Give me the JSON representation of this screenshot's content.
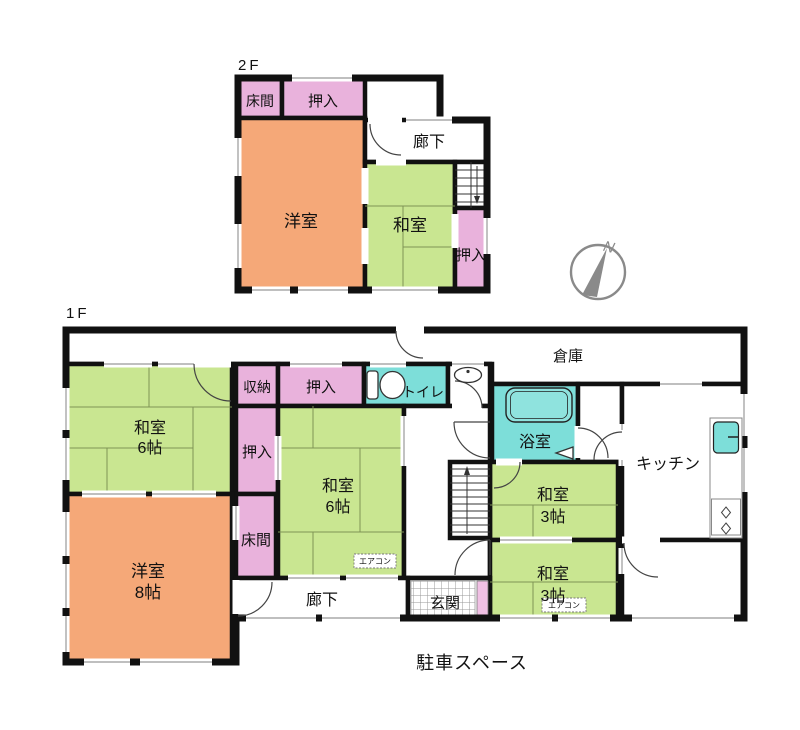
{
  "palette": {
    "wall": "#111111",
    "window_line": "#999999",
    "room_green": "#C9E691",
    "room_orange": "#F5A878",
    "room_pink": "#E9B2DC",
    "room_cyan": "#7DDED9",
    "bathtub_cyan": "#8FE3DE",
    "genkan_pink": "#F0C0E4",
    "compass_gray": "#8A8A8A",
    "tatami_line": "#7E9455"
  },
  "floor2": {
    "label": "2F",
    "tokonoma": "床間",
    "oshiire_top": "押入",
    "youshitsu": "洋室",
    "rouka": "廊下",
    "washitsu": "和室",
    "oshiire_side": "押入"
  },
  "floor1": {
    "label": "1F",
    "souko": "倉庫",
    "washitsu6_left": {
      "name": "和室",
      "size": "6帖"
    },
    "shuunou": "収納",
    "oshiire_top": "押入",
    "toilet": "トイレ",
    "oshiire_mid": "押入",
    "washitsu6_center": {
      "name": "和室",
      "size": "6帖"
    },
    "yokushitsu": "浴室",
    "kitchen": "キッチン",
    "tokonoma": "床間",
    "youshitsu8": {
      "name": "洋室",
      "size": "8帖"
    },
    "rouka": "廊下",
    "genkan": "玄関",
    "washitsu3_top": {
      "name": "和室",
      "size": "3帖"
    },
    "washitsu3_bottom": {
      "name": "和室",
      "size": "3帖"
    },
    "aircon_center": "エアコン",
    "aircon_bottom": "エアコン"
  },
  "compass": {
    "north": "N"
  },
  "caption": {
    "parking": "駐車スペース"
  }
}
